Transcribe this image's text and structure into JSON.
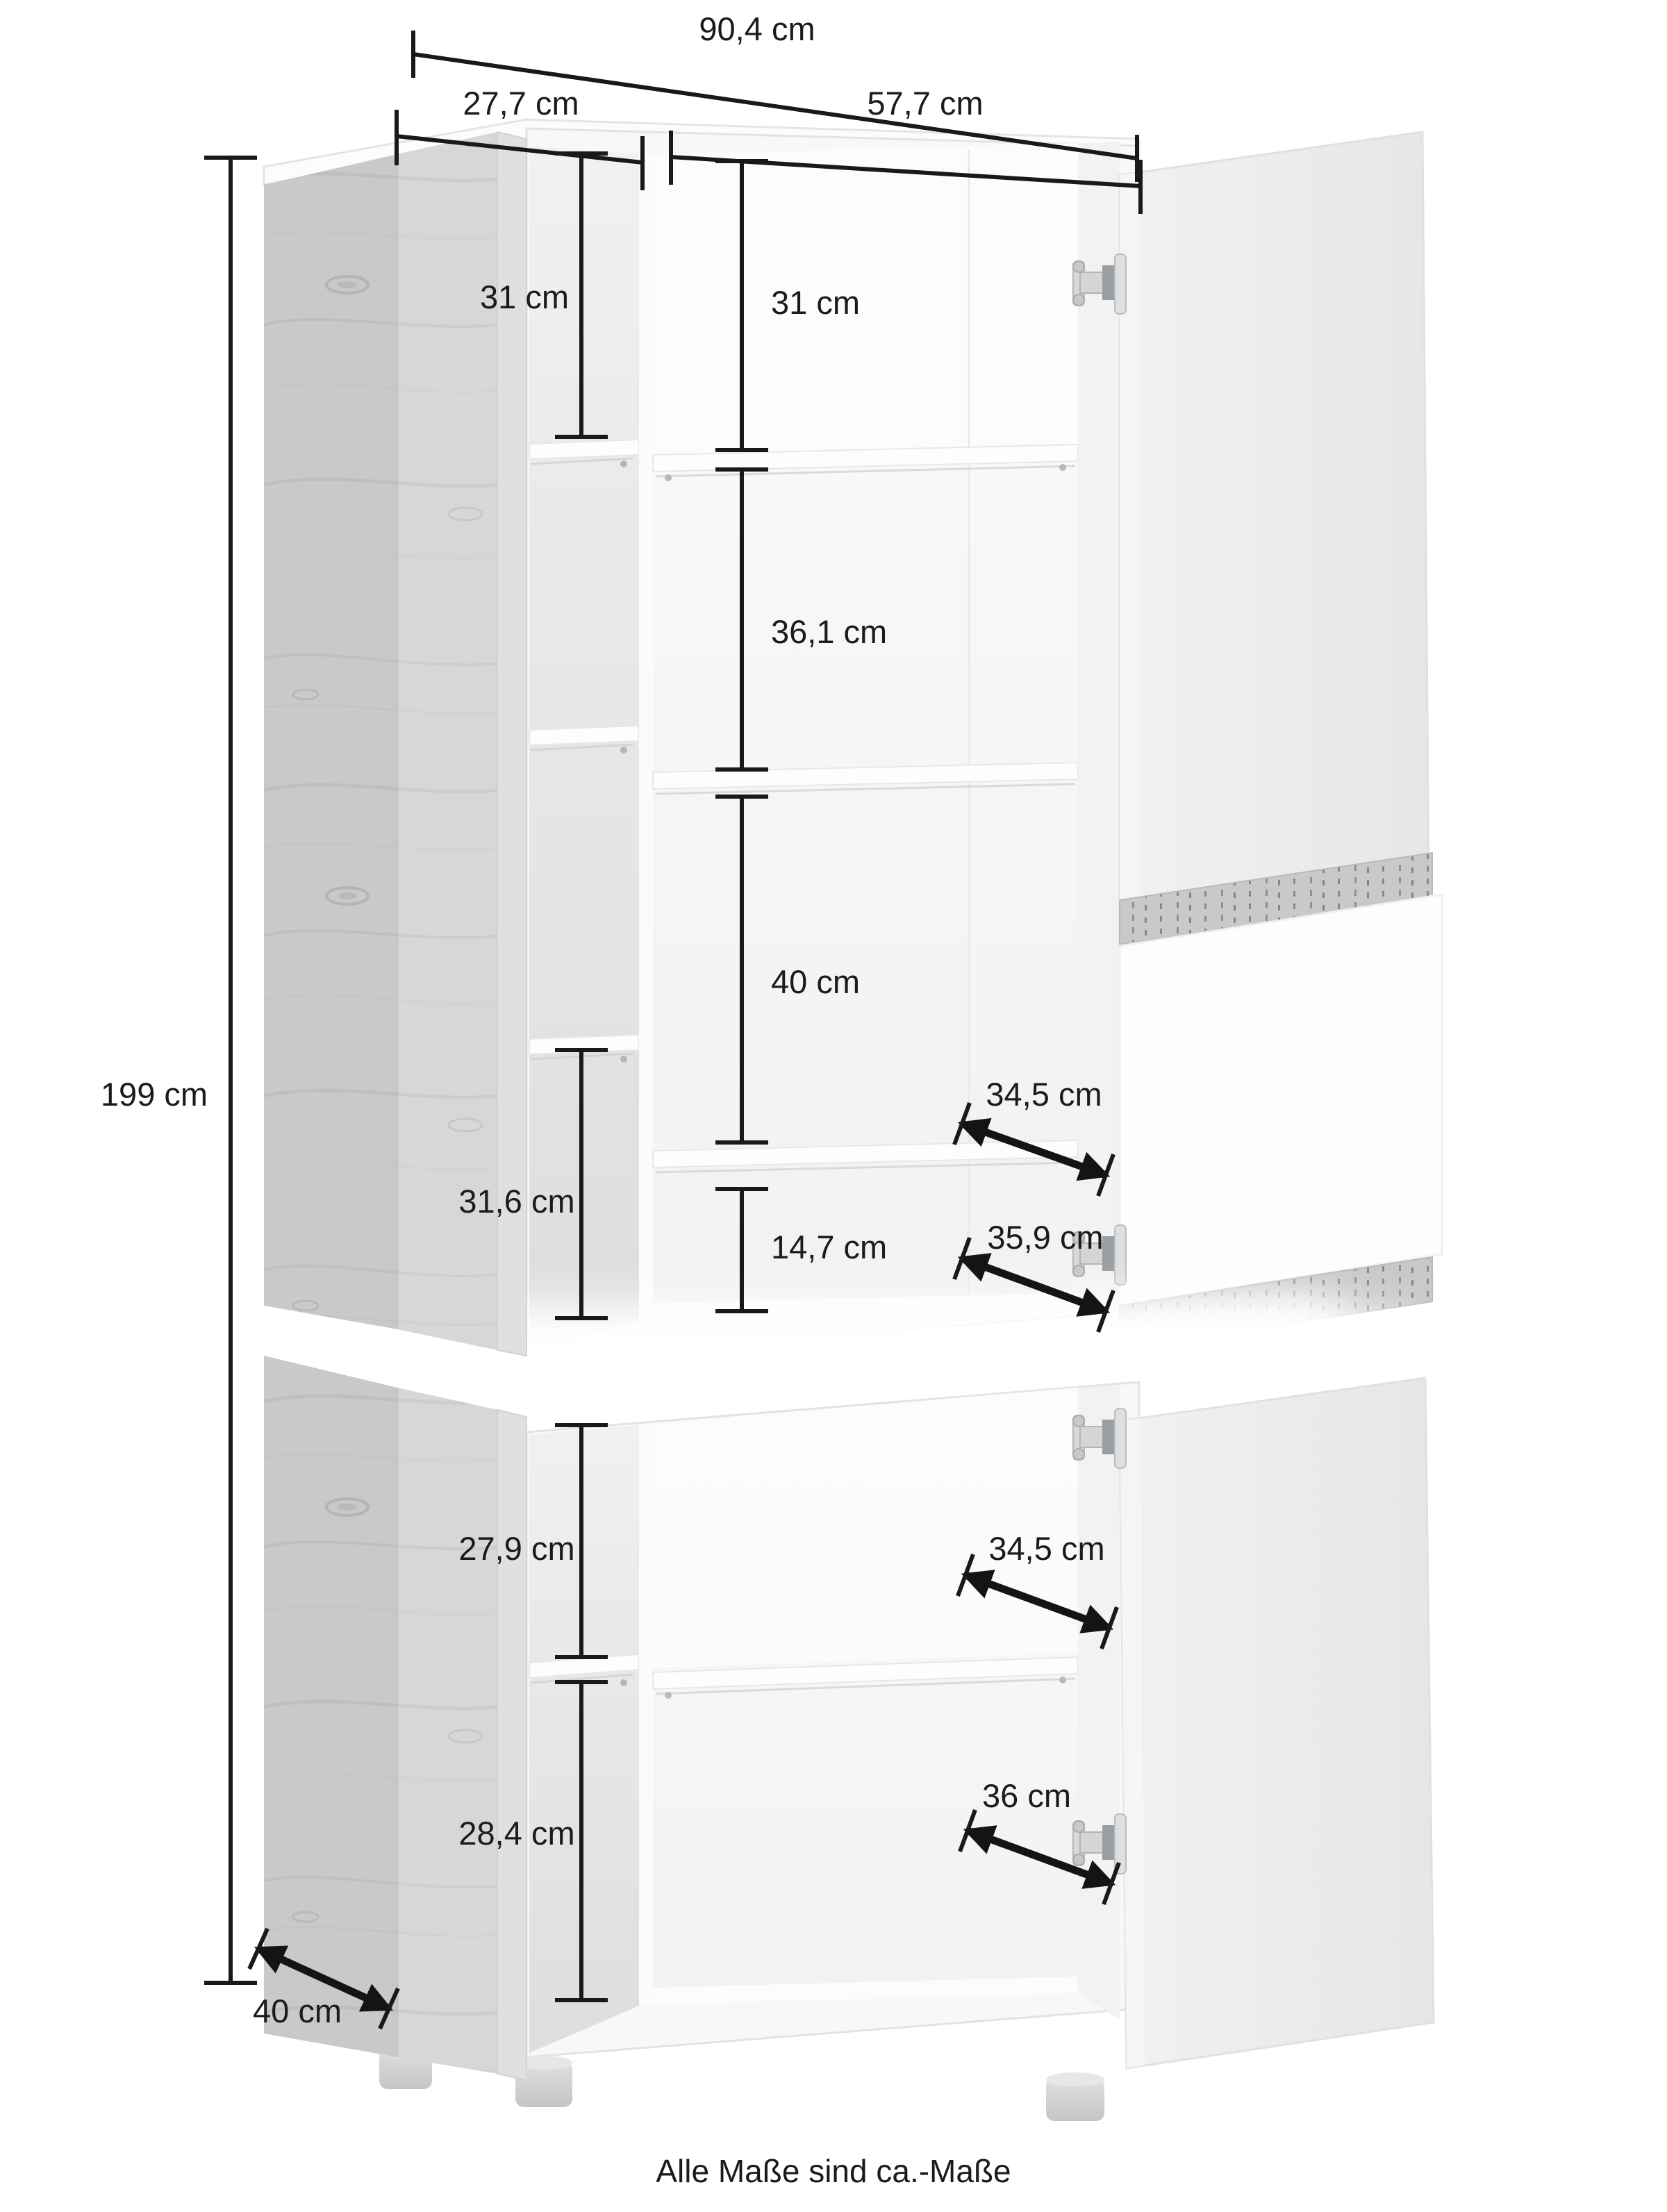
{
  "note": "Alle Maße sind ca.-Maße",
  "colors": {
    "dimension_line": "#1a1a1a",
    "wood_front": "#d2d3d3",
    "carcass_white": "#f7f8f8",
    "door_gray": "#ebedee",
    "glass_white": "#fdfdfe",
    "led_glow": "#ffffff"
  },
  "dimensions": {
    "total_width": "90,4 cm",
    "left_section_width": "27,7 cm",
    "main_section_width": "57,7 cm",
    "total_height": "199 cm",
    "depth": "40 cm",
    "upper_unit": {
      "left_top_compartment": "31 cm",
      "main_top_compartment": "31 cm",
      "main_second_compartment": "36,1 cm",
      "main_third_compartment": "40 cm",
      "shelf_depth_upper": "34,5 cm",
      "left_bottom_compartment": "31,6 cm",
      "main_bottom_compartment": "14,7 cm",
      "shelf_depth_lower": "35,9 cm"
    },
    "lower_unit": {
      "left_compartment_top": "27,9 cm",
      "shelf_depth_top": "34,5 cm",
      "left_compartment_bottom": "28,4 cm",
      "shelf_depth_bottom": "36 cm"
    }
  }
}
